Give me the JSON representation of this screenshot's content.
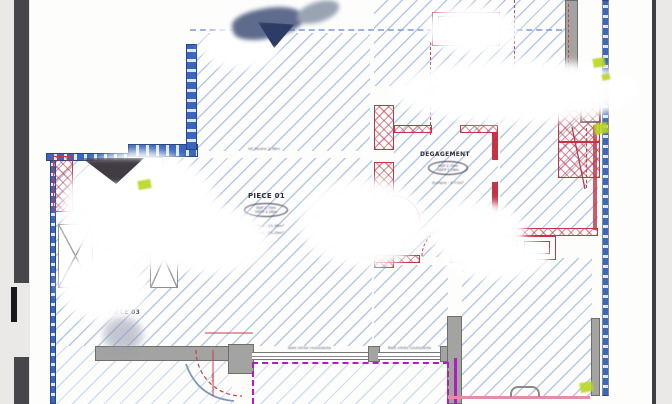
{
  "document": {
    "type": "architectural-floor-plan-photo",
    "rooms": {
      "piece01": {
        "label": "PIECE 01",
        "hsp": "HSP 2.70m",
        "hsfp": "HSFP 2.26m",
        "surface": "Surface : 21.96m²",
        "volume": "Volume : 59.29m³"
      },
      "degagement": {
        "label": "DEGAGEMENT",
        "hsp": "HSP 2.70m",
        "hsfp": "HSFP 2.26m",
        "surface": "Surface : 4.71m²"
      },
      "piece03": {
        "label": "PIECE 03"
      }
    },
    "annotations": {
      "hs_poutre": "HS Poutre 2.38m",
      "baie1": "Baie vitrée coulissante",
      "baie2": "Baie vitrée coulissante",
      "door_diameter": "⌀ 29",
      "dim_a": "2.40",
      "dim_b": "0.90",
      "dim_c": "1.26"
    },
    "colors": {
      "wall_blue": "#3a67bd",
      "hatch_blue": "#7a9cd6",
      "wall_red": "#c23446",
      "wall_gray": "#a3a3a1",
      "terrace_magenta": "#b31cc2",
      "pink_line": "#e78ca6",
      "highlight_green": "#b9d622",
      "frame_dark": "#47474b",
      "background_gray": "#eae9e7"
    }
  }
}
